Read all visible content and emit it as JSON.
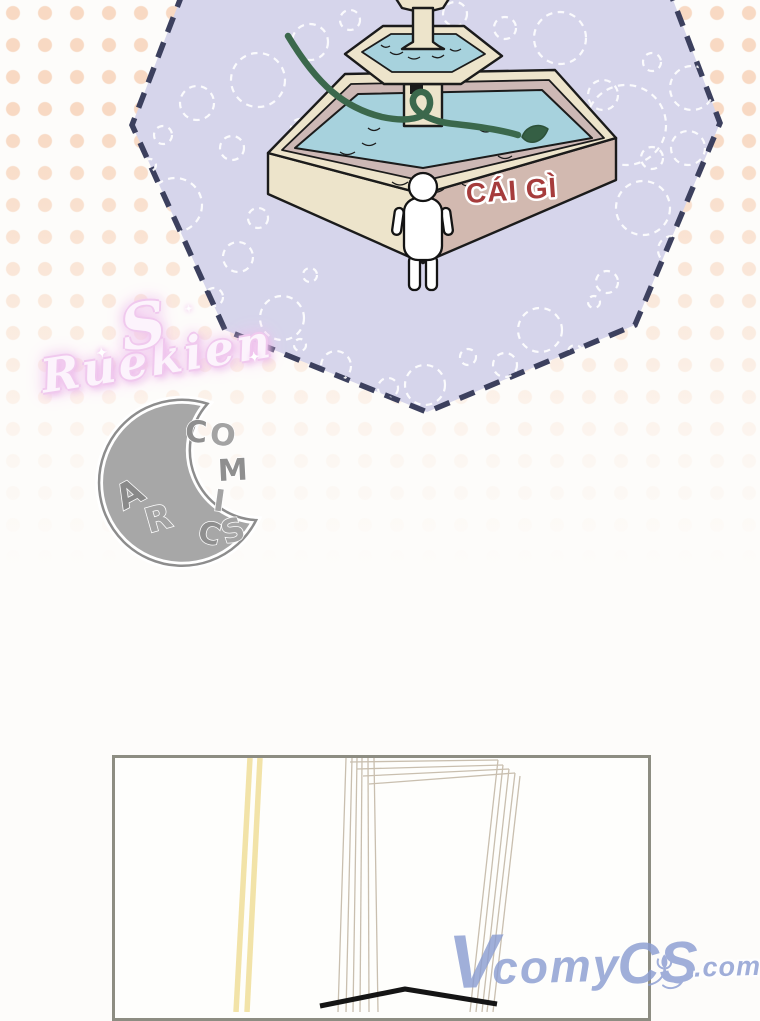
{
  "panel1": {
    "speech": "CÁI GÌ"
  },
  "watermarks": {
    "group": {
      "flourish": "S",
      "text": "Ruekien",
      "sparkle": "✦"
    },
    "moon": {
      "letters": [
        "A",
        "R",
        "C",
        "O",
        "M",
        "I",
        "C",
        "S"
      ]
    },
    "site": {
      "v": "V",
      "mid": "comy",
      "cs": "CS",
      "suffix": ".com"
    }
  },
  "colors": {
    "panel_bg": "#d6d5eb",
    "panel_border": "#3c405e",
    "water": "#a7d2dd",
    "stone_light": "#ede4cb",
    "stone_pink": "#d2b9b0",
    "vine": "#3b684c",
    "speech": "#a63c3c",
    "dots": "#f8d9c3",
    "panel2_border": "#8d8d82",
    "site_watermark": "#8c9ed2"
  }
}
